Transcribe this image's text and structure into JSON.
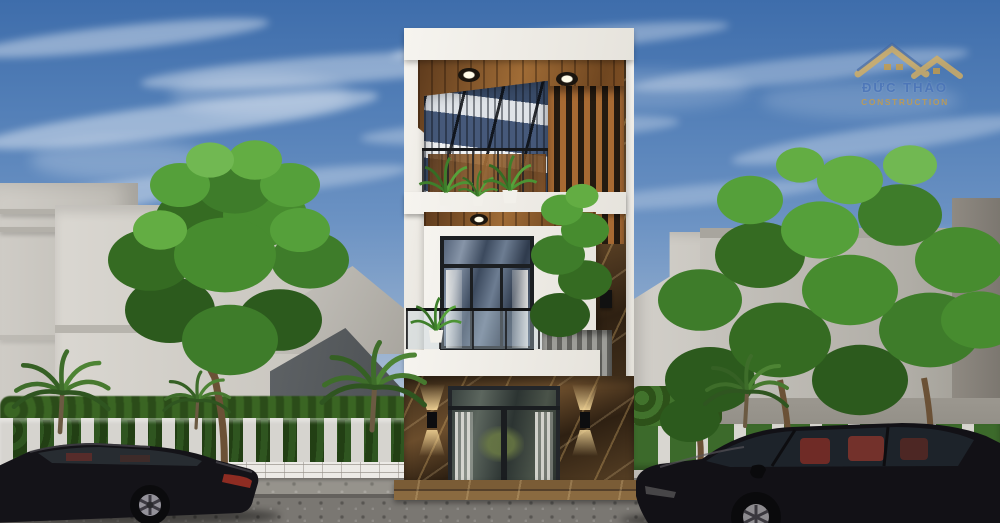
{
  "watermark": {
    "brand": "ĐỨC THẢO",
    "tagline": "CONSTRUCTION",
    "brand_color": "#4a74b8",
    "tagline_color": "#c99d45"
  },
  "scene": {
    "description": "3D exterior architectural render of a modern three-storey townhouse on a street with neighboring houses, trees, slat fence with hedges and two black cars",
    "palette": {
      "sky_top": "#3e6dab",
      "sky_horizon": "#b7c5d8",
      "cloud": "#ffffff",
      "facade_white": "#f4f2ed",
      "wood": "#8a5526",
      "louver_wood": "#a76a33",
      "marble_brown": "#43301c",
      "marble_vein": "#c9a268",
      "window_glass": "#3d4f66",
      "foliage": "#3e7c2a",
      "hedge": "#2c4a1c",
      "fence_slat": "#d3d1cc",
      "neighbor_gray": "#c6c3bd",
      "gable_wall_gray": "#54585b",
      "street": "#7a7772",
      "car_black": "#17161a",
      "car_seat_red": "#8a352c",
      "sconce_glow": "#ffe1a0"
    }
  }
}
